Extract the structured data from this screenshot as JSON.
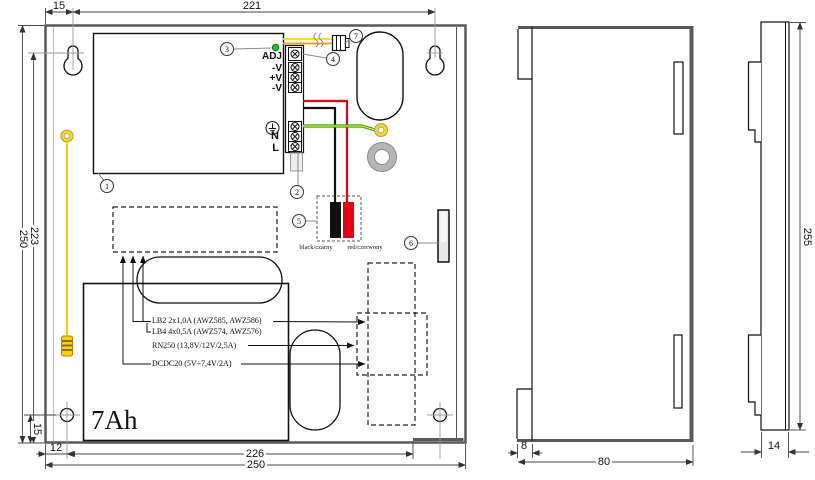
{
  "front_view": {
    "dims": {
      "mount_offset_top": "15",
      "mount_span": "221",
      "height_inner": "223",
      "height_outer": "250",
      "hole_offset_v": "15",
      "hole_offset_h": "12",
      "width_inner": "226",
      "width_outer": "250"
    },
    "terminals": {
      "adj": "ADJ",
      "v_minus_1": "-V",
      "v_plus": "+V",
      "v_minus_2": "-V",
      "neutral": "N",
      "line": "L"
    },
    "battery_capacity": "7Ah",
    "battery_leads": {
      "black": "black/czarny",
      "red": "red/czerwony"
    },
    "module_notes": {
      "lb2": "LB2 2x1,0A (AWZ585, AWZ586)",
      "lb4": "LB4 4x0,5A (AWZ574, AWZ576)",
      "rn250": "RN250 (13,8V/12V/2,5A)",
      "dcdc20": "DCDC20 (5V÷7,4V/2A)"
    },
    "callouts": {
      "c1": "1",
      "c2": "2",
      "c3": "3",
      "c4": "4",
      "c5": "5",
      "c6": "6",
      "c7": "7"
    }
  },
  "side_view": {
    "dims": {
      "lip": "8",
      "depth": "80"
    }
  },
  "door_view": {
    "dims": {
      "height": "255",
      "thickness": "14"
    }
  },
  "colors": {
    "outline": "#595959",
    "wire_red": "#e60012",
    "wire_black": "#111111",
    "wire_yellow": "#ffd900",
    "wire_orange": "#ff9a00",
    "wire_green": "#1e9e1e",
    "wire_green_stripe": "#ffe600",
    "led": "#2ebd2e",
    "earth_ring": "#ffd900",
    "grommet": "#b5b5b5",
    "tamper": "#e8e8e8"
  }
}
